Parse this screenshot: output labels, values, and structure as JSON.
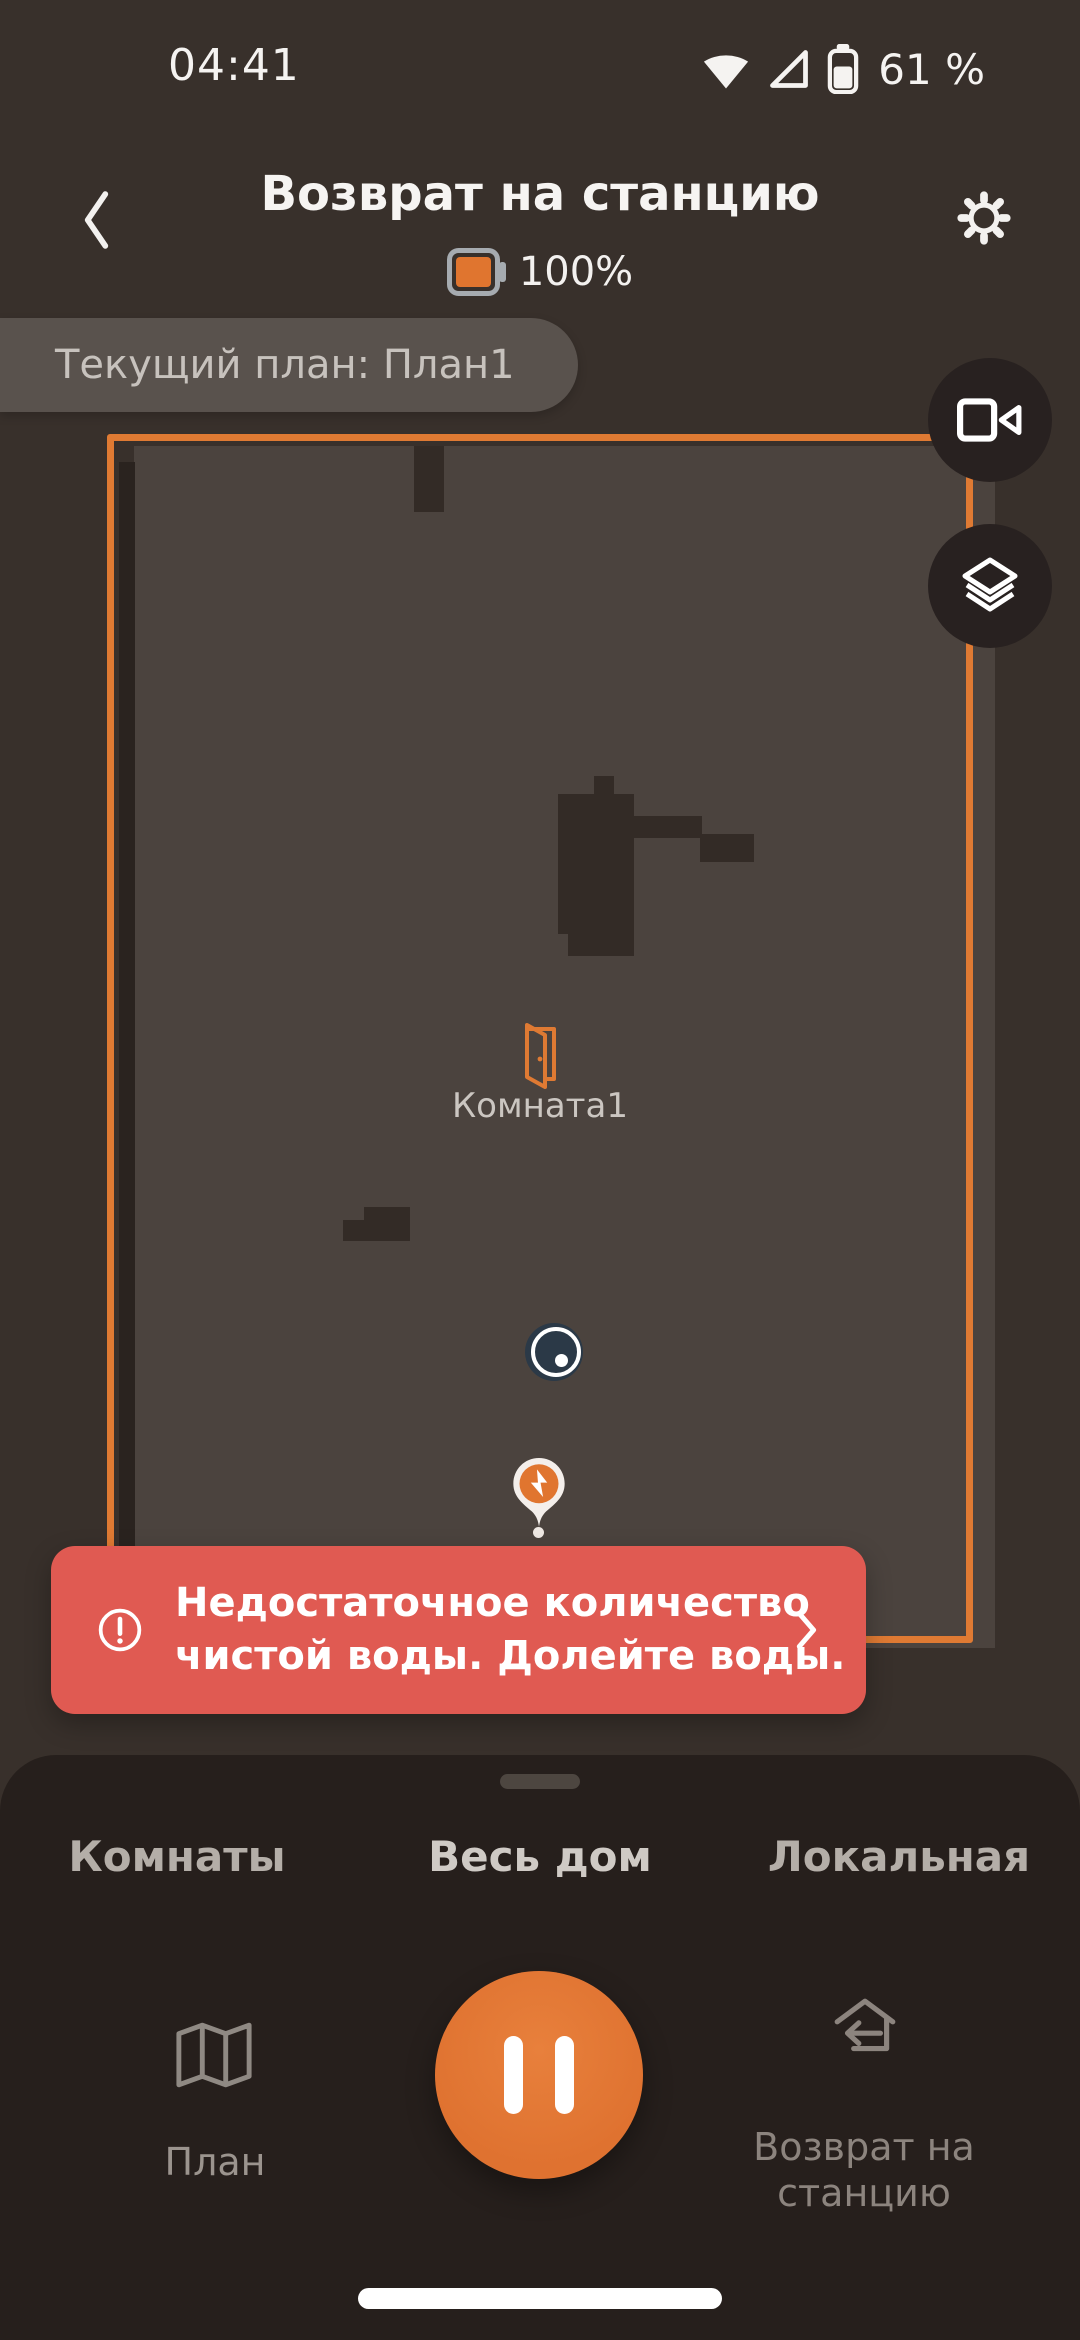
{
  "status_bar": {
    "time": "04:41",
    "battery_percent": "61 %"
  },
  "header": {
    "title": "Возврат на станцию",
    "robot_battery_percent": "100%"
  },
  "plan_banner": {
    "text": "Текущий план: План1"
  },
  "map": {
    "room_label": "Комната1"
  },
  "alert": {
    "line1": "Недостаточное количество",
    "line2": "чистой воды. Долейте воды."
  },
  "sheet": {
    "tabs": [
      {
        "label": "Комнаты",
        "selected": false
      },
      {
        "label": "Весь дом",
        "selected": true
      },
      {
        "label": "Локальная",
        "selected": false
      }
    ],
    "controls": {
      "plan_label": "План",
      "return_label": "Возврат на станцию"
    }
  },
  "colors": {
    "accent_orange": "#df7a33",
    "alert_red": "#e05a52",
    "map_interior": "#4b433e",
    "page_background": "#38302b",
    "sheet_background": "#261f1c"
  },
  "icons": [
    "wifi-icon",
    "cellular-icon",
    "battery-icon",
    "back-icon",
    "gear-icon",
    "robot-battery-icon",
    "video-camera-icon",
    "layers-icon",
    "door-icon",
    "robot-marker",
    "dock-marker",
    "warning-icon",
    "chevron-right-icon",
    "map-icon",
    "pause-icon",
    "return-to-dock-icon"
  ]
}
